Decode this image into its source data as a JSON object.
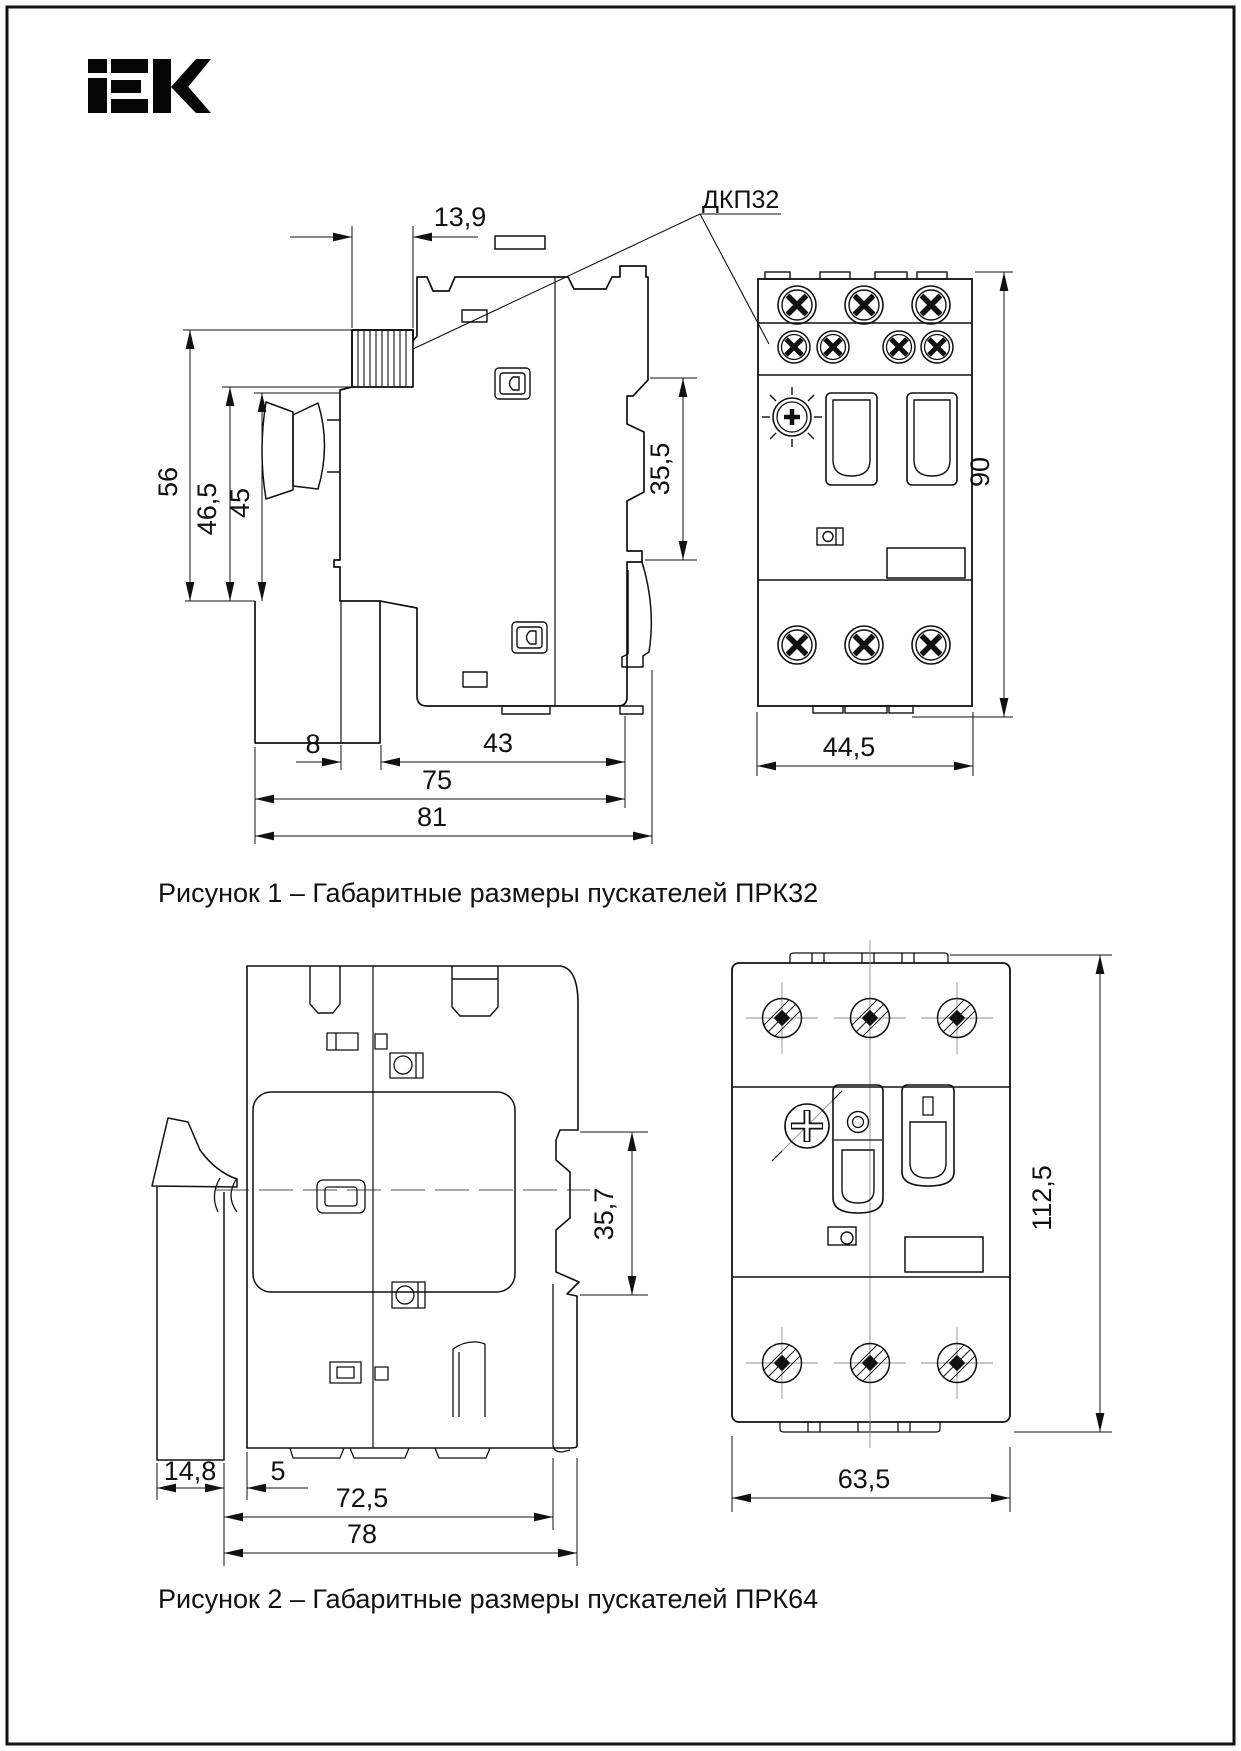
{
  "page": {
    "brand": "iEK"
  },
  "figure1": {
    "caption": "Рисунок 1 – Габаритные размеры пускателей ПРК32",
    "callout_label": "ДКП32",
    "side_view": {
      "dims": {
        "ribbed_width": "13,9",
        "height_total": "56",
        "height_mid": "46,5",
        "height_knob": "45",
        "din_height": "35,5",
        "foot_offset": "8",
        "depth_body": "43",
        "depth_mid": "75",
        "depth_total": "81"
      }
    },
    "front_view": {
      "dims": {
        "height": "90",
        "width": "44,5"
      }
    }
  },
  "figure2": {
    "caption": "Рисунок 2 – Габаритные размеры  пускателей ПРК64",
    "side_view": {
      "dims": {
        "din_height": "35,7",
        "lever_depth": "14,8",
        "gap": "5",
        "depth_mid": "72,5",
        "depth_total": "78"
      }
    },
    "front_view": {
      "dims": {
        "height": "112,5",
        "width": "63,5"
      }
    }
  }
}
